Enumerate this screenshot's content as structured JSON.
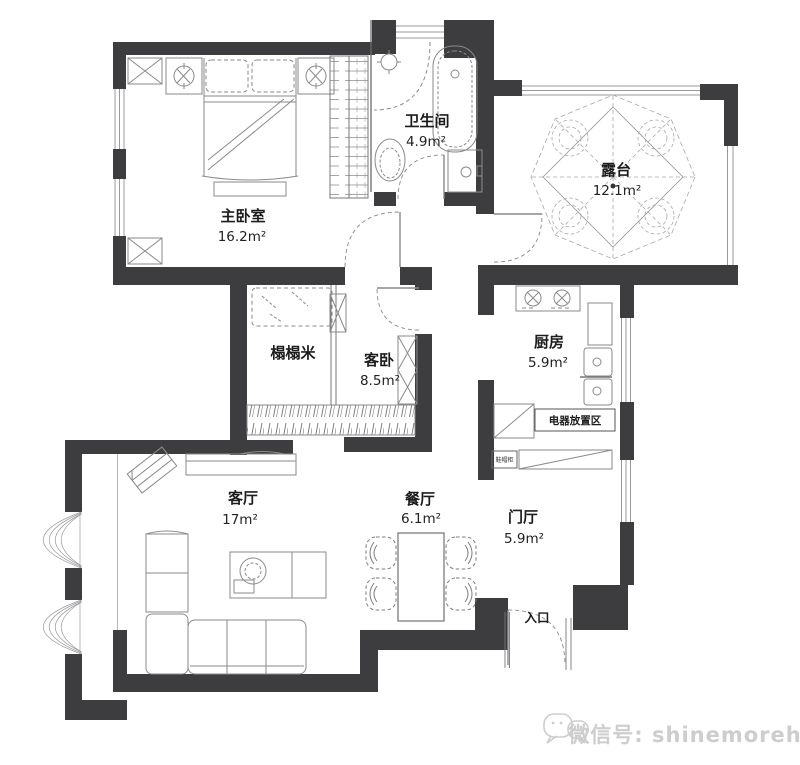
{
  "rooms": {
    "master_bedroom": {
      "name": "主卧室",
      "area": "16.2m²"
    },
    "bathroom": {
      "name": "卫生间",
      "area": "4.9m²"
    },
    "terrace": {
      "name": "露台",
      "area": "12.1m²"
    },
    "tatami": {
      "name": "榻榻米"
    },
    "guest_bedroom": {
      "name": "客卧",
      "area": "8.5m²"
    },
    "kitchen": {
      "name": "厨房",
      "area": "5.9m²"
    },
    "appliance_area": {
      "name": "电器放置区"
    },
    "shoe_cabinet": {
      "name": "鞋帽柜"
    },
    "living_room": {
      "name": "客厅",
      "area": "17m²"
    },
    "dining_room": {
      "name": "餐厅",
      "area": "6.1m²"
    },
    "entrance_hall": {
      "name": "门厅",
      "area": "5.9m²"
    },
    "entrance": {
      "name": "入口"
    }
  },
  "watermark": {
    "text": "微信号: shinemorehn",
    "icon": "wechat-icon"
  },
  "colors": {
    "wall": "#3d3d3f",
    "furniture_line": "#8a8a8a",
    "light_line": "#a8a8a8",
    "watermark": "#cdcdcd"
  }
}
